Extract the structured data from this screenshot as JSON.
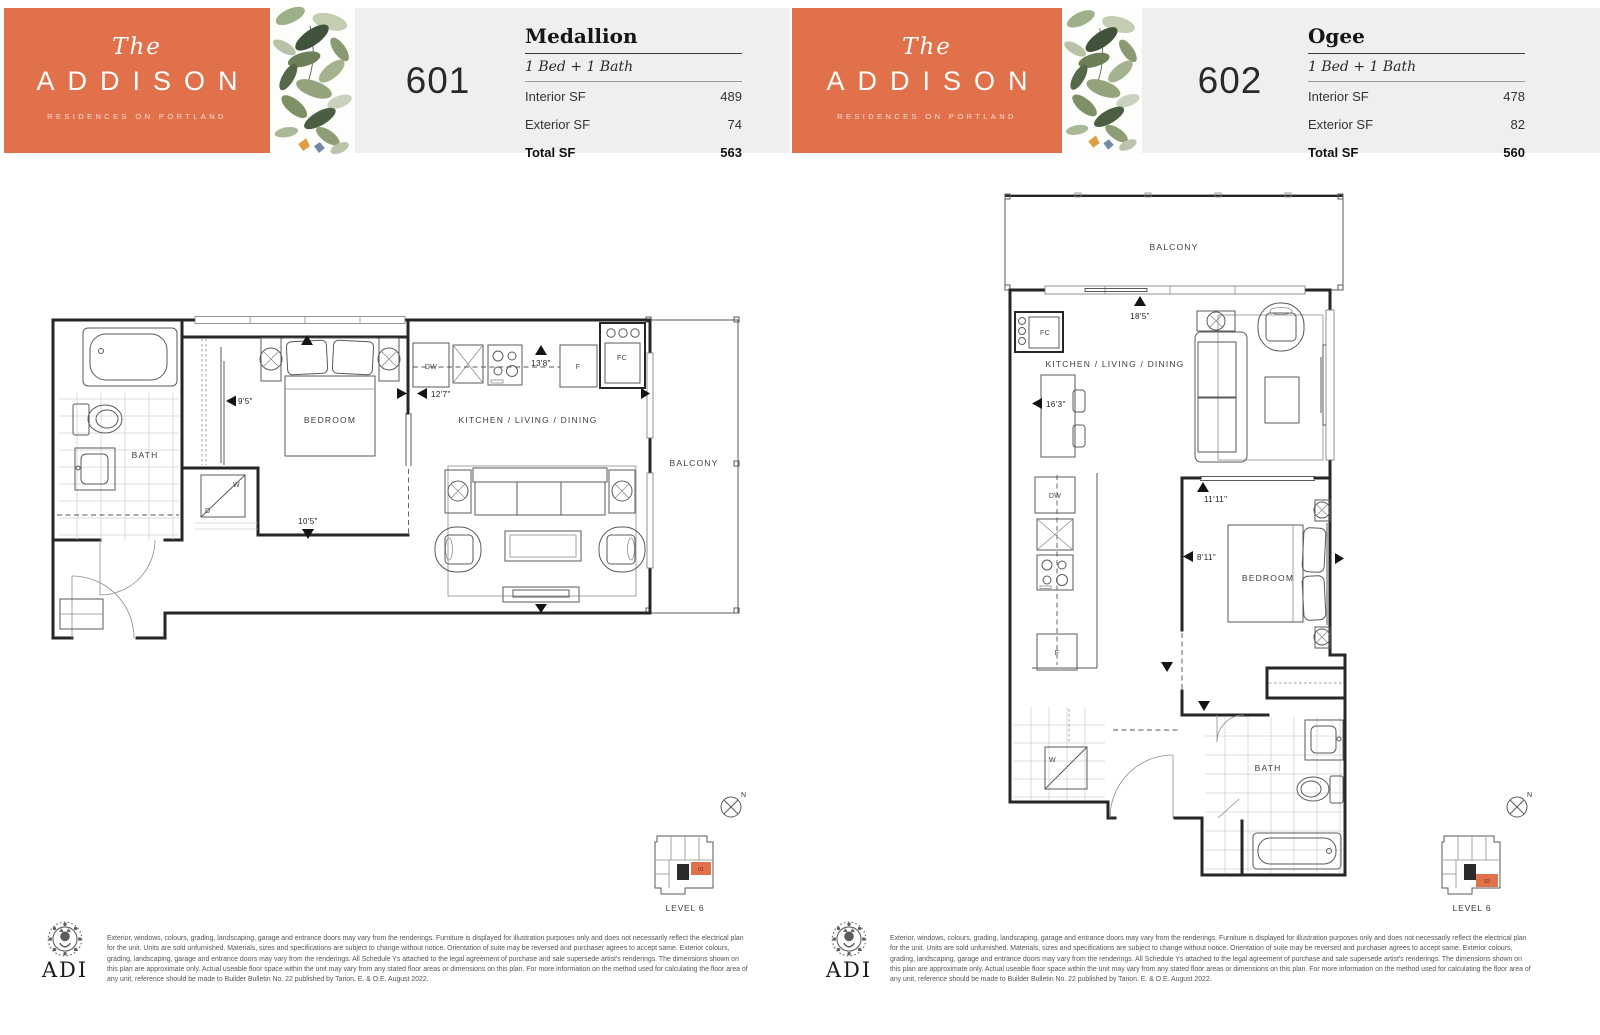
{
  "brand": {
    "the": "The",
    "name": "ADDISON",
    "tagline": "RESIDENCES ON PORTLAND"
  },
  "units": [
    {
      "number": "601",
      "plan_name": "Medallion",
      "bed_bath": "1 Bed + 1 Bath",
      "specs": {
        "rows": [
          {
            "label": "Interior SF",
            "value": "489"
          },
          {
            "label": "Exterior SF",
            "value": "74"
          },
          {
            "label": "Total SF",
            "value": "563"
          }
        ]
      },
      "plan": {
        "bath": "BATH",
        "bedroom": "BEDROOM",
        "kld": "KITCHEN / LIVING / DINING",
        "balcony": "BALCONY",
        "dw": "DW",
        "f": "F",
        "fc": "FC",
        "w": "W",
        "d": "D",
        "dim_bedroom_width": "9'5\"",
        "dim_bedroom_length": "10'5\"",
        "dim_living_width": "12'7\"",
        "dim_kitchen_length": "13'8\""
      },
      "keyplan": {
        "unit": "01",
        "level": "LEVEL 6",
        "north": "N"
      }
    },
    {
      "number": "602",
      "plan_name": "Ogee",
      "bed_bath": "1 Bed + 1 Bath",
      "specs": {
        "rows": [
          {
            "label": "Interior SF",
            "value": "478"
          },
          {
            "label": "Exterior SF",
            "value": "82"
          },
          {
            "label": "Total SF",
            "value": "560"
          }
        ]
      },
      "plan": {
        "bath": "BATH",
        "bedroom": "BEDROOM",
        "kld": "KITCHEN / LIVING / DINING",
        "balcony": "BALCONY",
        "dw": "DW",
        "f": "F",
        "fc": "FC",
        "w": "W",
        "dim_living_length": "18'5\"",
        "dim_living_width": "16'3\"",
        "dim_bedroom_length": "11'11\"",
        "dim_bedroom_width": "8'11\""
      },
      "keyplan": {
        "unit": "02",
        "level": "LEVEL 6",
        "north": "N"
      }
    }
  ],
  "footer": {
    "logo": "ADI",
    "disclaimer": "Exterior, windows, colours, grading, landscaping, garage and entrance doors may vary from the renderings. Furniture is displayed for illustration purposes only and does not necessarily reflect the electrical plan for the unit. Units are sold unfurnished. Materials, sizes and specifications are subject to change without notice. Orientation of suite may be reversed and purchaser agrees to accept same. Exterior colours, grading, landscaping, garage and entrance doors may vary from the renderings. All Schedule Ys attached to the legal agreement of purchase and sale supersede artist's renderings. The dimensions shown on this plan are approximate only. Actual useable floor space within the unit may vary from any stated floor areas or dimensions on this plan. For more information on the method used for calculating the floor area of any unit, reference should be made to Builder Bulletin No. 22 published by Tarion. E. & O.E. August 2022."
  },
  "colors": {
    "brand_orange": "#E0714B",
    "header_bg": "#EFEFEF",
    "keyplan_highlight": "#E0714B",
    "wall": "#262626"
  }
}
